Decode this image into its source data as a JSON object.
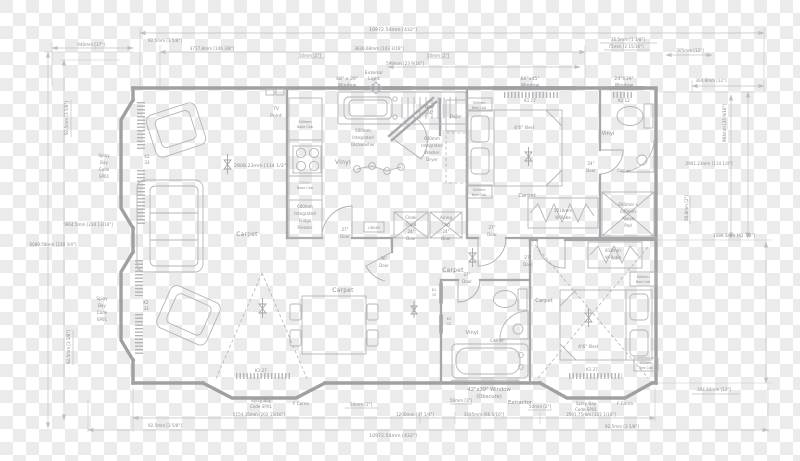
{
  "dimensions": {
    "top": [
      "10972.54mm [432\"]",
      "940mm [37\"]",
      "92.5mm [3 5/8\"]",
      "3717.8mm [146 3/8\"]",
      "3636.68mm [143 3/16\"]",
      "50mm [2\"]",
      "50mm [2\"]",
      "599mm [23 9/16\"]",
      "35.5mm [1 3/8\"]",
      "75mm [2 15/16\"]",
      "305mm [12\"]"
    ],
    "right": [
      "304.8mm [12\"]",
      "904mm [35 9/16\"]",
      "2901.23mm [114 1/4\"]",
      "50.8mm [2\"]",
      "1089.5mm [42 7/8\"]",
      "304.84mm [12\"]"
    ],
    "bottom": [
      "92.5mm [3 5/8\"]",
      "5154.35mm [202 15/16\"]",
      "50mm [2\"]",
      "1200mm [47 1/4\"]",
      "50mm [2\"]",
      "1685mm [66 5/16\"]",
      "50mm [2\"]",
      "2591.75mm [102 1/16\"]",
      "92.5mm [3 5/8\"]",
      "10972.54mm [432\"]"
    ],
    "left": [
      "5964.5mm [234 13/16\"]",
      "6089.58mm [239 3/4\"]",
      "92.5mm [3 5/8\"]",
      "92.5mm [3 5/8\"]"
    ],
    "lounge_width_note": "2908.23mm [114 1/2\"]"
  },
  "windows": {
    "kitchen": [
      "48\" x 39\"",
      "Window"
    ],
    "bedroom1": [
      "66\"x45\"",
      "Window",
      "K1 27"
    ],
    "bathroom1": [
      "24\"X39\"",
      "Window",
      "K2 12"
    ],
    "bay_code_k2": [
      "K2",
      "33"
    ],
    "bay_code_k1": "K1 27",
    "bath2_side1": [
      "K1",
      "15"
    ],
    "bath2_side2": [
      "K2",
      "12"
    ],
    "bath2_window": [
      "42\"x39\" Window",
      "(Obscure)"
    ],
    "extractor": "Extractor"
  },
  "splay": {
    "stack": [
      "Splay",
      "Bay",
      "Code",
      "SP01"
    ],
    "two_line": [
      "Splay Bay",
      "Code SP01"
    ],
    "corner_note": "F Corna"
  },
  "flooring": {
    "lounge": "Carpet",
    "dining": "Carpet",
    "hall": "Carpet",
    "bedroom1": "Carpet",
    "bedroom2": "Carpet",
    "kitchen": "Vinyl",
    "bathroom1": "Vinyl",
    "bathroom2": "Vinyl"
  },
  "fixtures": {
    "tv_point": [
      "TV",
      "Point"
    ],
    "exterior_light": [
      "Exterior",
      "Light"
    ],
    "boiler": "Boiler",
    "dishwasher": [
      "600mm",
      "Integrated",
      "Dishwasher"
    ],
    "fridge_freezer": [
      "600mm",
      "Integrated",
      "Fridge",
      "Freezer"
    ],
    "washer_dryer": [
      "600mm",
      "Integrated",
      "Washer",
      "Dryer"
    ],
    "cloak_cupboard": [
      "Cloak",
      "Cupd",
      "24\"",
      "Door"
    ],
    "airing_cupboard": [
      "Airing",
      "Cbd",
      "24\"",
      "Door"
    ],
    "wardrobe1": [
      "1218mm",
      "W/Robe"
    ],
    "wardrobe2": [
      "818mm",
      "W/Robe"
    ],
    "bed_cabinet": [
      "300mm",
      "Bed Cab"
    ],
    "above_pod": [
      "600mm x",
      "600mm",
      "Above",
      "Pod"
    ],
    "corner_unit": "Corner",
    "bed": "4'6\" Bed",
    "base_cab_500": [
      "500mm",
      "Base Cab"
    ],
    "base_cab_300": [
      "300mm",
      "Base Cab"
    ],
    "unit_code": "OB04R"
  },
  "doors": {
    "d24": [
      "24\"",
      "Door"
    ],
    "d27": [
      "27\"",
      "Door"
    ],
    "d36": [
      "36\"",
      "Door"
    ],
    "entry": [
      "Door",
      "24\""
    ]
  }
}
